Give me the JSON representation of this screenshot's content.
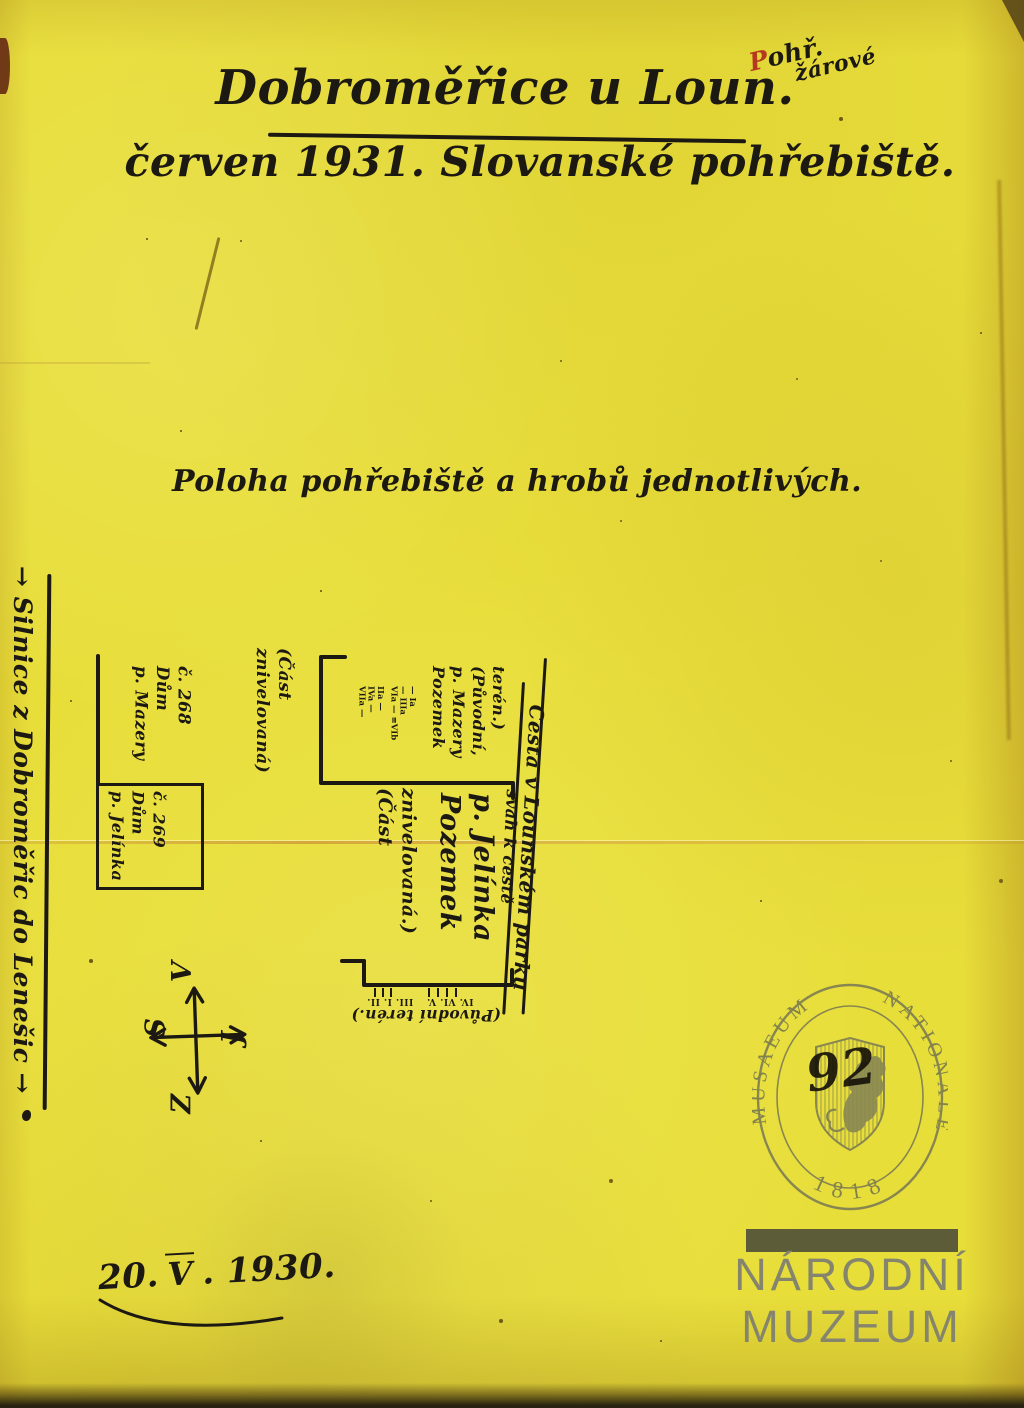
{
  "annotation": {
    "line1": "Pohř.",
    "line2": "žárové"
  },
  "title": {
    "text": "Dobroměřice u Loun."
  },
  "subtitle": {
    "text": "červen 1931. Slovanské pohřebiště."
  },
  "heading": {
    "text": "Poloha pohřebiště a hrobů jednotlivých."
  },
  "map": {
    "road_left_label": "→ Silnice z Dobroměřic do Lenešic →",
    "house_268": {
      "lines": [
        "č. 268",
        "Dům",
        "p. Mazery"
      ]
    },
    "house_269": {
      "lines": [
        "č. 269",
        "Dům",
        "p. Jelínka"
      ]
    },
    "leveled_part_upper": {
      "lines": [
        "(Část",
        "znivelovaná)"
      ]
    },
    "mazera_plot": {
      "lines": [
        "Pozemek",
        "p. Mazery",
        "(Původní,",
        "terén.)"
      ]
    },
    "jelinek_plot": {
      "lines": [
        "Pozemek",
        "p. Jelínka"
      ]
    },
    "jelinek_plot_note": {
      "lines": [
        "(Část",
        "znivelovaná.)"
      ]
    },
    "graves_upper_a": {
      "lines": [
        "VIIa —",
        "IVa —",
        "IIa —"
      ]
    },
    "graves_upper_b": {
      "lines": [
        "VIa — ≡VIb",
        "— IIIa",
        "— Ia"
      ]
    },
    "graves_lower_a": "III.  I.  II.",
    "graves_lower_b": "IV.  VI.  V.",
    "original_terrain_label": "(Původní terén.)",
    "road_right_label": "Cesta v Lounském parku",
    "slope_label": "svah k cestě",
    "compass": {
      "top": "V",
      "left": "S",
      "right": "J",
      "bottom": "Z"
    }
  },
  "date_note": {
    "day": "20.",
    "month": "V",
    "year": ". 1930."
  },
  "seal": {
    "arc_left": "MUSAEUM",
    "arc_right": "NATIONALE",
    "year": "1818",
    "number": "92"
  },
  "watermark": {
    "line1": "NÁRODNÍ",
    "line2": "MUZEUM"
  }
}
